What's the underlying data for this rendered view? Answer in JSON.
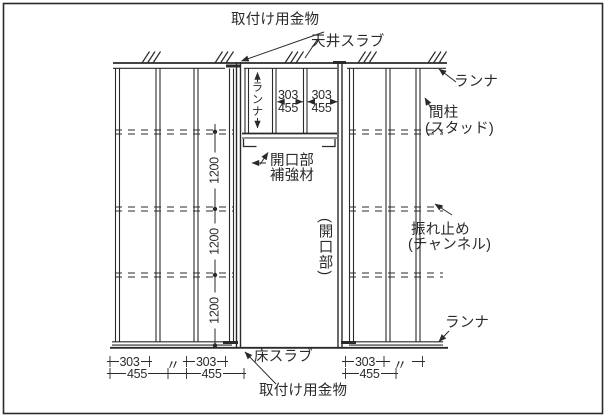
{
  "diagram_title": "steel-stud-wall-framing-elevation",
  "style": {
    "line_color": "#2a2a2a",
    "background": "#ffffff"
  },
  "labels": {
    "mounting_hardware_top": "取付け用金物",
    "ceiling_slab": "天井スラブ",
    "runner_top_right": "ランナ",
    "runner_opening_vertical": "ランナ",
    "stud_line1": "間柱",
    "stud_line2": "(スタッド)",
    "opening_reinforcement_line1": "開口部",
    "opening_reinforcement_line2": "補強材",
    "opening_vertical": "(開口部)",
    "bracing_line1": "振れ止め",
    "bracing_line2": "(チャンネル)",
    "runner_bottom_right": "ランナ",
    "floor_slab": "床スラブ",
    "mounting_hardware_bottom": "取付け用金物"
  },
  "dimensions": {
    "stud_pitch_top": [
      {
        "primary": "303",
        "alt": "455"
      },
      {
        "primary": "303",
        "alt": "455"
      }
    ],
    "bracing_spacing": [
      "1200",
      "1200",
      "1200"
    ],
    "stud_pitch_bottom_left": [
      {
        "primary": "303",
        "alt": "455"
      },
      {
        "primary": "303",
        "alt": "455"
      }
    ],
    "stud_pitch_bottom_right": [
      {
        "primary": "303",
        "alt": "455"
      }
    ],
    "ditto_mark": "〃"
  }
}
